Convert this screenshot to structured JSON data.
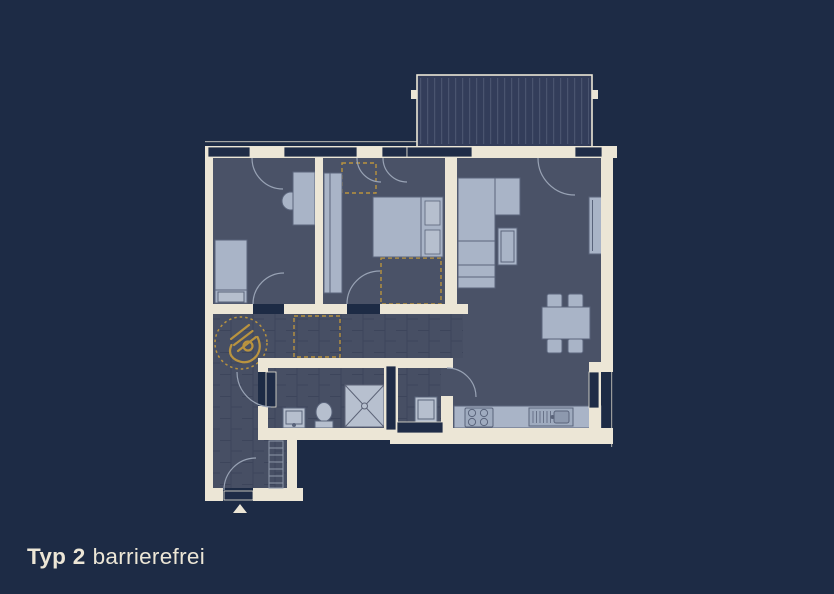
{
  "canvas": {
    "width": 834,
    "height": 594,
    "background": "#1d2b45"
  },
  "caption": {
    "type_label": "Typ 2",
    "variant_label": "barrierefrei"
  },
  "colors": {
    "background": "#1d2b45",
    "wall": "#ece6d6",
    "floor": "#4a5267",
    "tile_floor": "#474f64",
    "tile_grout": "#3d455b",
    "window": "#1f2c47",
    "furniture_fill": "#a9b4c7",
    "furniture_light": "#b6bfce",
    "furniture_stroke": "#5a647b",
    "door_arc": "#98a2b4",
    "accent_gold": "#b9933f",
    "balcony_fill": "#333d5a",
    "balcony_stripe": "#4a546f"
  },
  "floor_plan": {
    "type": "apartment-floor-plan",
    "accessibility_symbol": "wheelchair-turning-circle",
    "balcony_position": "top",
    "entrance_marker": "triangle-bottom-left",
    "rooms": [
      {
        "name": "bedroom-1",
        "furniture": [
          "single-bed",
          "desk",
          "desk-chair"
        ]
      },
      {
        "name": "bedroom-2",
        "furniture": [
          "double-bed",
          "wardrobe",
          "dashed-wardrobe-zones"
        ]
      },
      {
        "name": "living-dining",
        "furniture": [
          "corner-sofa",
          "coffee-table",
          "dining-table",
          "dining-chairs",
          "sideboard"
        ]
      },
      {
        "name": "kitchen",
        "furniture": [
          "kitchen-counter",
          "cooktop",
          "sink"
        ]
      },
      {
        "name": "bathroom",
        "furniture": [
          "shower",
          "toilet",
          "washbasin"
        ]
      },
      {
        "name": "storage-room",
        "furniture": [
          "washing-machine"
        ]
      },
      {
        "name": "hallway",
        "furniture": [
          "coat-rack",
          "wheelchair-turning-circle"
        ]
      }
    ]
  }
}
